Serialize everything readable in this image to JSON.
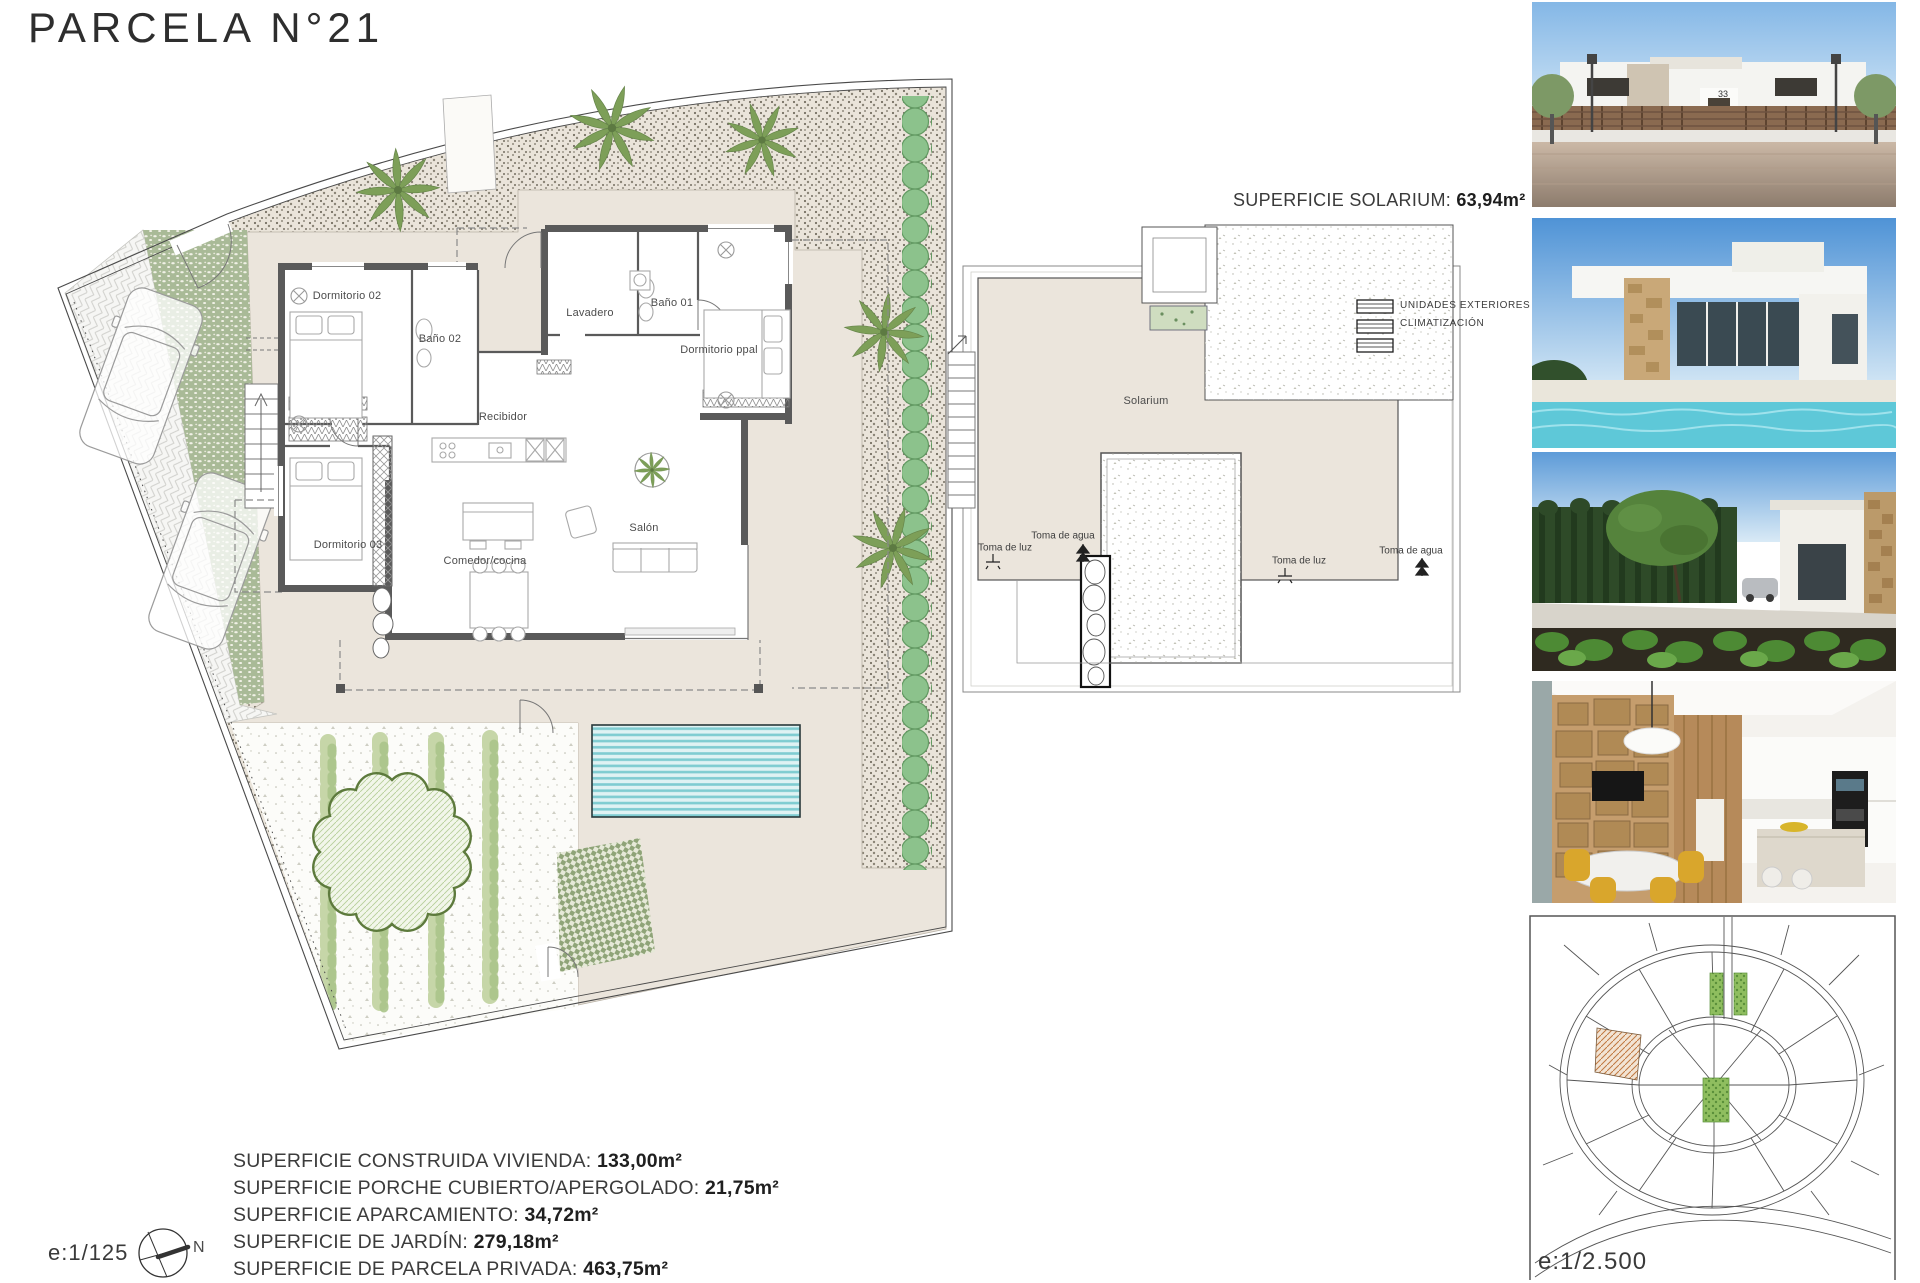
{
  "page": {
    "title": "PARCELA N°21"
  },
  "floor_plan": {
    "rooms": [
      {
        "label": "Dormitorio 02"
      },
      {
        "label": "Baño 02"
      },
      {
        "label": "Lavadero"
      },
      {
        "label": "Baño 01"
      },
      {
        "label": "Dormitorio ppal"
      },
      {
        "label": "Recibidor"
      },
      {
        "label": "Dormitorio 03"
      },
      {
        "label": "Comedor/cocina"
      },
      {
        "label": "Salón"
      }
    ]
  },
  "solarium": {
    "heading_label": "SUPERFICIE SOLARIUM:",
    "heading_value": "63,94m²",
    "area_label": "Solarium",
    "units_line1": "UNIDADES EXTERIORES",
    "units_line2": "CLIMATIZACIÓN",
    "water_label": "Toma de agua",
    "light_label": "Toma de luz"
  },
  "surfaces": [
    {
      "label": "SUPERFICIE CONSTRUIDA VIVIENDA:",
      "value": "133,00m²"
    },
    {
      "label": "SUPERFICIE PORCHE CUBIERTO/APERGOLADO:",
      "value": "21,75m²"
    },
    {
      "label": "SUPERFICIE APARCAMIENTO:",
      "value": "34,72m²"
    },
    {
      "label": "SUPERFICIE DE JARDÍN:",
      "value": "279,18m²"
    },
    {
      "label": "SUPERFICIE DE PARCELA PRIVADA:",
      "value": "463,75m²"
    }
  ],
  "scale_plan": "e:1/125",
  "scale_map": "e:1/2.500",
  "compass_north": "N",
  "photos": {
    "house_number": "33"
  },
  "colors": {
    "terrace": "#ebe5dc",
    "wall": "#5a5a5a",
    "vegetation": "#7d9f58",
    "hedge": "#8cc28c",
    "pool_stripe": "#7fccd1",
    "parcel_hatch": "#c07840"
  }
}
